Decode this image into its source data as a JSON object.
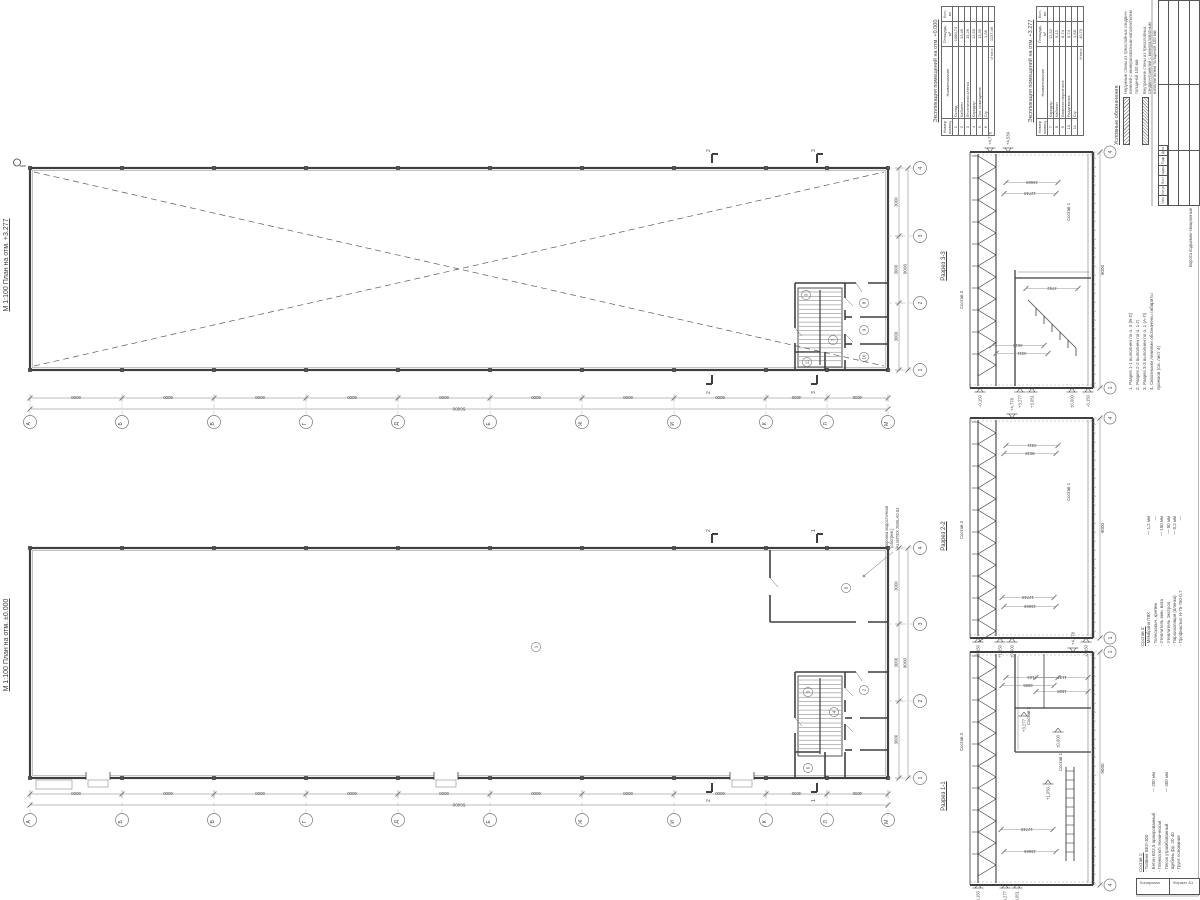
{
  "colors": {
    "ink": "#3f3f3f",
    "dim": "#787878",
    "bg": "#ffffff"
  },
  "tables": [
    {
      "title": "Экспликация помещений на отм. +0.000",
      "headers": {
        "num": "Номер помещ.",
        "name": "Наименование",
        "area": "Площадь, м²",
        "count": "Кол-во"
      },
      "rows": [
        {
          "n": "1",
          "name": "Склад",
          "area": "1080,74"
        },
        {
          "n": "2",
          "name": "Кабинет",
          "area": "13,49"
        },
        {
          "n": "3",
          "name": "Лестничная клетка",
          "area": "15,26"
        },
        {
          "n": "4",
          "name": "Коридор",
          "area": "12,50"
        },
        {
          "n": "5",
          "name": "Тех. помещение",
          "area": "13,49"
        },
        {
          "n": "6",
          "name": "С/у",
          "area": "1,58"
        }
      ],
      "total_label": "Итого:",
      "total_value": "1137,06"
    },
    {
      "title": "Экспликация помещений на отм. +3.277",
      "headers": {
        "num": "Номер помещ.",
        "name": "Наименование",
        "area": "Площадь, м²",
        "count": "Кол-во"
      },
      "rows": [
        {
          "n": "7",
          "name": "Коридор",
          "area": "12,52"
        },
        {
          "n": "8",
          "name": "Кабинет",
          "area": "9,12"
        },
        {
          "n": "9",
          "name": "Комната персонала",
          "area": "8,74"
        },
        {
          "n": "10",
          "name": "Раздевалка",
          "area": "8,74"
        },
        {
          "n": "11",
          "name": "С/у",
          "area": "1,58"
        }
      ],
      "total_label": "Итого:",
      "total_value": "40,70"
    }
  ],
  "legend": {
    "title": "Условные обозначения",
    "items": [
      "Наружные стены из трехслойных сэндвич-панелей с минераловатным наполнителем толщиной 100 мм",
      "Внутренние стены из трехслойных сэндвич-панелей с минераловатным наполнителем толщиной 100 мм"
    ]
  },
  "notes": {
    "items": [
      "1. Разрез 1-1 выполнен по о. 4 (В-Л)",
      "2. Разрез 2-2 выполнен по о. 1-Л",
      "3. Разрез 3-3 выполнен по о. 1 (А-Л)",
      "4. Сквозными линиями обозначены габариты проемов (см. лист 4)"
    ]
  },
  "gates_note": "Ворота подъемно-секционные",
  "membrane_note": {
    "line1": "Воронка водосточная (обогрев.)",
    "line2": "ALMITEX 2506.А0.04"
  },
  "sostav3": {
    "title": "Состав 3:",
    "items": [
      {
        "name": "Мембрана ПВХ",
        "value": "— 1,2 мм"
      },
      {
        "name": "Телескопич. крепеж",
        "value": "—"
      },
      {
        "name": "Утеплитель мин. вата",
        "value": "— 150 мм"
      },
      {
        "name": "Утеплитель Экстрол",
        "value": "— 50 мм"
      },
      {
        "name": "Пароизоляция (пленка)",
        "value": "— 0,2 мм"
      },
      {
        "name": "Профнастил Н-75-750-0,7",
        "value": "—"
      }
    ]
  },
  "sostav1": {
    "title": "Состав 1:",
    "items": [
      {
        "name": "Топпинг ВЕЛ-300",
        "value": ""
      },
      {
        "name": "Бетон В22,5 армированный",
        "value": "— 200 мм"
      },
      {
        "name": "Пленка п/э техническая",
        "value": ""
      },
      {
        "name": "Песок утрамбованный",
        "value": "— 300 мм"
      },
      {
        "name": "Щебень фр. 20-40",
        "value": ""
      },
      {
        "name": "Грунт основания",
        "value": ""
      }
    ]
  },
  "stamp": {
    "rev_headers": [
      "Изм",
      "Кол.уч",
      "Лист",
      "№док",
      "Подп",
      "Дата"
    ]
  },
  "footer": {
    "left": "Копировал",
    "right": "Формат А1"
  },
  "plans": [
    {
      "label": "М 1:100  План на отм. +3.277",
      "letter_axes": [
        "А",
        "Б",
        "В",
        "Г",
        "Д",
        "Е",
        "Ж",
        "И",
        "К",
        "Л",
        "М"
      ],
      "bay_dims": [
        "6000",
        "6000",
        "6000",
        "6000",
        "6000",
        "6000",
        "6000",
        "6000",
        "4000",
        "4000"
      ],
      "total_dim": "56000",
      "num_axes": [
        "1",
        "2",
        "3",
        "4"
      ],
      "num_dims": [
        "3000",
        "3000",
        "3000"
      ],
      "num_total": "9000",
      "cut_marks": [
        {
          "x": 712,
          "l": "2"
        },
        {
          "x": 817,
          "l": "3"
        }
      ],
      "rooms": [
        {
          "n": "3",
          "x": 806,
          "y": 295
        },
        {
          "n": "7",
          "x": 833,
          "y": 340
        },
        {
          "n": "8",
          "x": 864,
          "y": 303
        },
        {
          "n": "9",
          "x": 864,
          "y": 330
        },
        {
          "n": "10",
          "x": 864,
          "y": 357
        },
        {
          "n": "11",
          "x": 807,
          "y": 362
        }
      ]
    },
    {
      "label": "М 1:100  План на отм. ±0.000",
      "letter_axes": [
        "А",
        "Б",
        "В",
        "Г",
        "Д",
        "Е",
        "Ж",
        "И",
        "К",
        "Л",
        "М"
      ],
      "bay_dims": [
        "6000",
        "6000",
        "6000",
        "6000",
        "6000",
        "6000",
        "6000",
        "6000",
        "4000",
        "4000"
      ],
      "total_dim": "56000",
      "num_axes": [
        "1",
        "2",
        "3",
        "4"
      ],
      "num_dims": [
        "3000",
        "3000",
        "3000"
      ],
      "num_total": "9000",
      "cut_marks": [
        {
          "x": 712,
          "l": "2"
        },
        {
          "x": 817,
          "l": "1"
        }
      ],
      "rooms": [
        {
          "n": "1",
          "x": 536,
          "y": 647
        },
        {
          "n": "2",
          "x": 864,
          "y": 690
        },
        {
          "n": "3",
          "x": 808,
          "y": 692
        },
        {
          "n": "4",
          "x": 834,
          "y": 712
        },
        {
          "n": "5",
          "x": 846,
          "y": 588
        },
        {
          "n": "6",
          "x": 808,
          "y": 768
        }
      ]
    }
  ],
  "sections": [
    {
      "label": "Разрез 3-3",
      "top_bubble": "4",
      "bottom_bubble": "1",
      "side_dim": "9000",
      "flags": [
        {
          "v": "+4,778",
          "x": 990,
          "y": 152,
          "d": "u"
        },
        {
          "v": "+4,539",
          "x": 1008,
          "y": 152,
          "d": "u"
        },
        {
          "v": "-0,150",
          "x": 980,
          "y": 388,
          "d": "d"
        },
        {
          "v": "+3,277",
          "x": 1020,
          "y": 388,
          "d": "d"
        },
        {
          "v": "+3,051",
          "x": 1032,
          "y": 388,
          "d": "d"
        },
        {
          "v": "±0,000",
          "x": 1072,
          "y": 388,
          "d": "d"
        },
        {
          "v": "-0,150",
          "x": 1088,
          "y": 388,
          "d": "d"
        }
      ],
      "inner_dims": [
        {
          "v": "15669",
          "x": 1032,
          "y": 181
        },
        {
          "v": "12748",
          "x": 1030,
          "y": 192
        },
        {
          "v": "4762",
          "x": 1052,
          "y": 287
        },
        {
          "v": "4610",
          "x": 1018,
          "y": 344
        },
        {
          "v": "4311",
          "x": 1022,
          "y": 352
        }
      ],
      "comp_labels": [
        {
          "v": "Состав 1",
          "x": 1070,
          "y": 212
        },
        {
          "v": "Состав 3",
          "x": 963,
          "y": 300
        }
      ]
    },
    {
      "label": "Разрез 2-2",
      "top_bubble": "4",
      "bottom_bubble": "1",
      "side_dim": "9000",
      "flags": [
        {
          "v": "+4,778",
          "x": 1012,
          "y": 418,
          "d": "u"
        },
        {
          "v": "-0,150",
          "x": 978,
          "y": 638,
          "d": "d"
        },
        {
          "v": "+1,050",
          "x": 1000,
          "y": 638,
          "d": "d"
        },
        {
          "v": "±0,000",
          "x": 1012,
          "y": 638,
          "d": "d"
        },
        {
          "v": "-0,150",
          "x": 1086,
          "y": 638,
          "d": "d"
        }
      ],
      "inner_dims": [
        {
          "v": "4311",
          "x": 1032,
          "y": 444
        },
        {
          "v": "9018",
          "x": 1030,
          "y": 452
        },
        {
          "v": "12748",
          "x": 1028,
          "y": 596
        },
        {
          "v": "15669",
          "x": 1030,
          "y": 605
        }
      ],
      "comp_labels": [
        {
          "v": "Состав 1",
          "x": 1070,
          "y": 492
        },
        {
          "v": "Состав 3",
          "x": 963,
          "y": 530
        }
      ]
    },
    {
      "label": "Разрез 1-1",
      "top_bubble": "1",
      "bottom_bubble": "4",
      "side_dim": "9000",
      "flags": [
        {
          "v": "+4,778",
          "x": 1073,
          "y": 652,
          "d": "u"
        },
        {
          "v": "+3,277",
          "x": 1024,
          "y": 712,
          "d": "d"
        },
        {
          "v": "±0,000",
          "x": 1058,
          "y": 728,
          "d": "d"
        },
        {
          "v": "+1,050",
          "x": 1048,
          "y": 780,
          "d": "d"
        },
        {
          "v": "-0,150",
          "x": 978,
          "y": 884,
          "d": "d"
        },
        {
          "v": "+3,277",
          "x": 1005,
          "y": 884,
          "d": "d"
        },
        {
          "v": "+3,051",
          "x": 1017,
          "y": 884,
          "d": "d"
        }
      ],
      "inner_dims": [
        {
          "v": "7164",
          "x": 1032,
          "y": 676
        },
        {
          "v": "6595",
          "x": 1028,
          "y": 684
        },
        {
          "v": "1137",
          "x": 1062,
          "y": 676
        },
        {
          "v": "1508",
          "x": 1062,
          "y": 690
        },
        {
          "v": "12748",
          "x": 1027,
          "y": 828
        },
        {
          "v": "15669",
          "x": 1030,
          "y": 850
        }
      ],
      "comp_labels": [
        {
          "v": "Состав 3",
          "x": 963,
          "y": 742
        },
        {
          "v": "Состав 2",
          "x": 1030,
          "y": 716
        },
        {
          "v": "Состав 1",
          "x": 1062,
          "y": 762
        }
      ]
    }
  ]
}
